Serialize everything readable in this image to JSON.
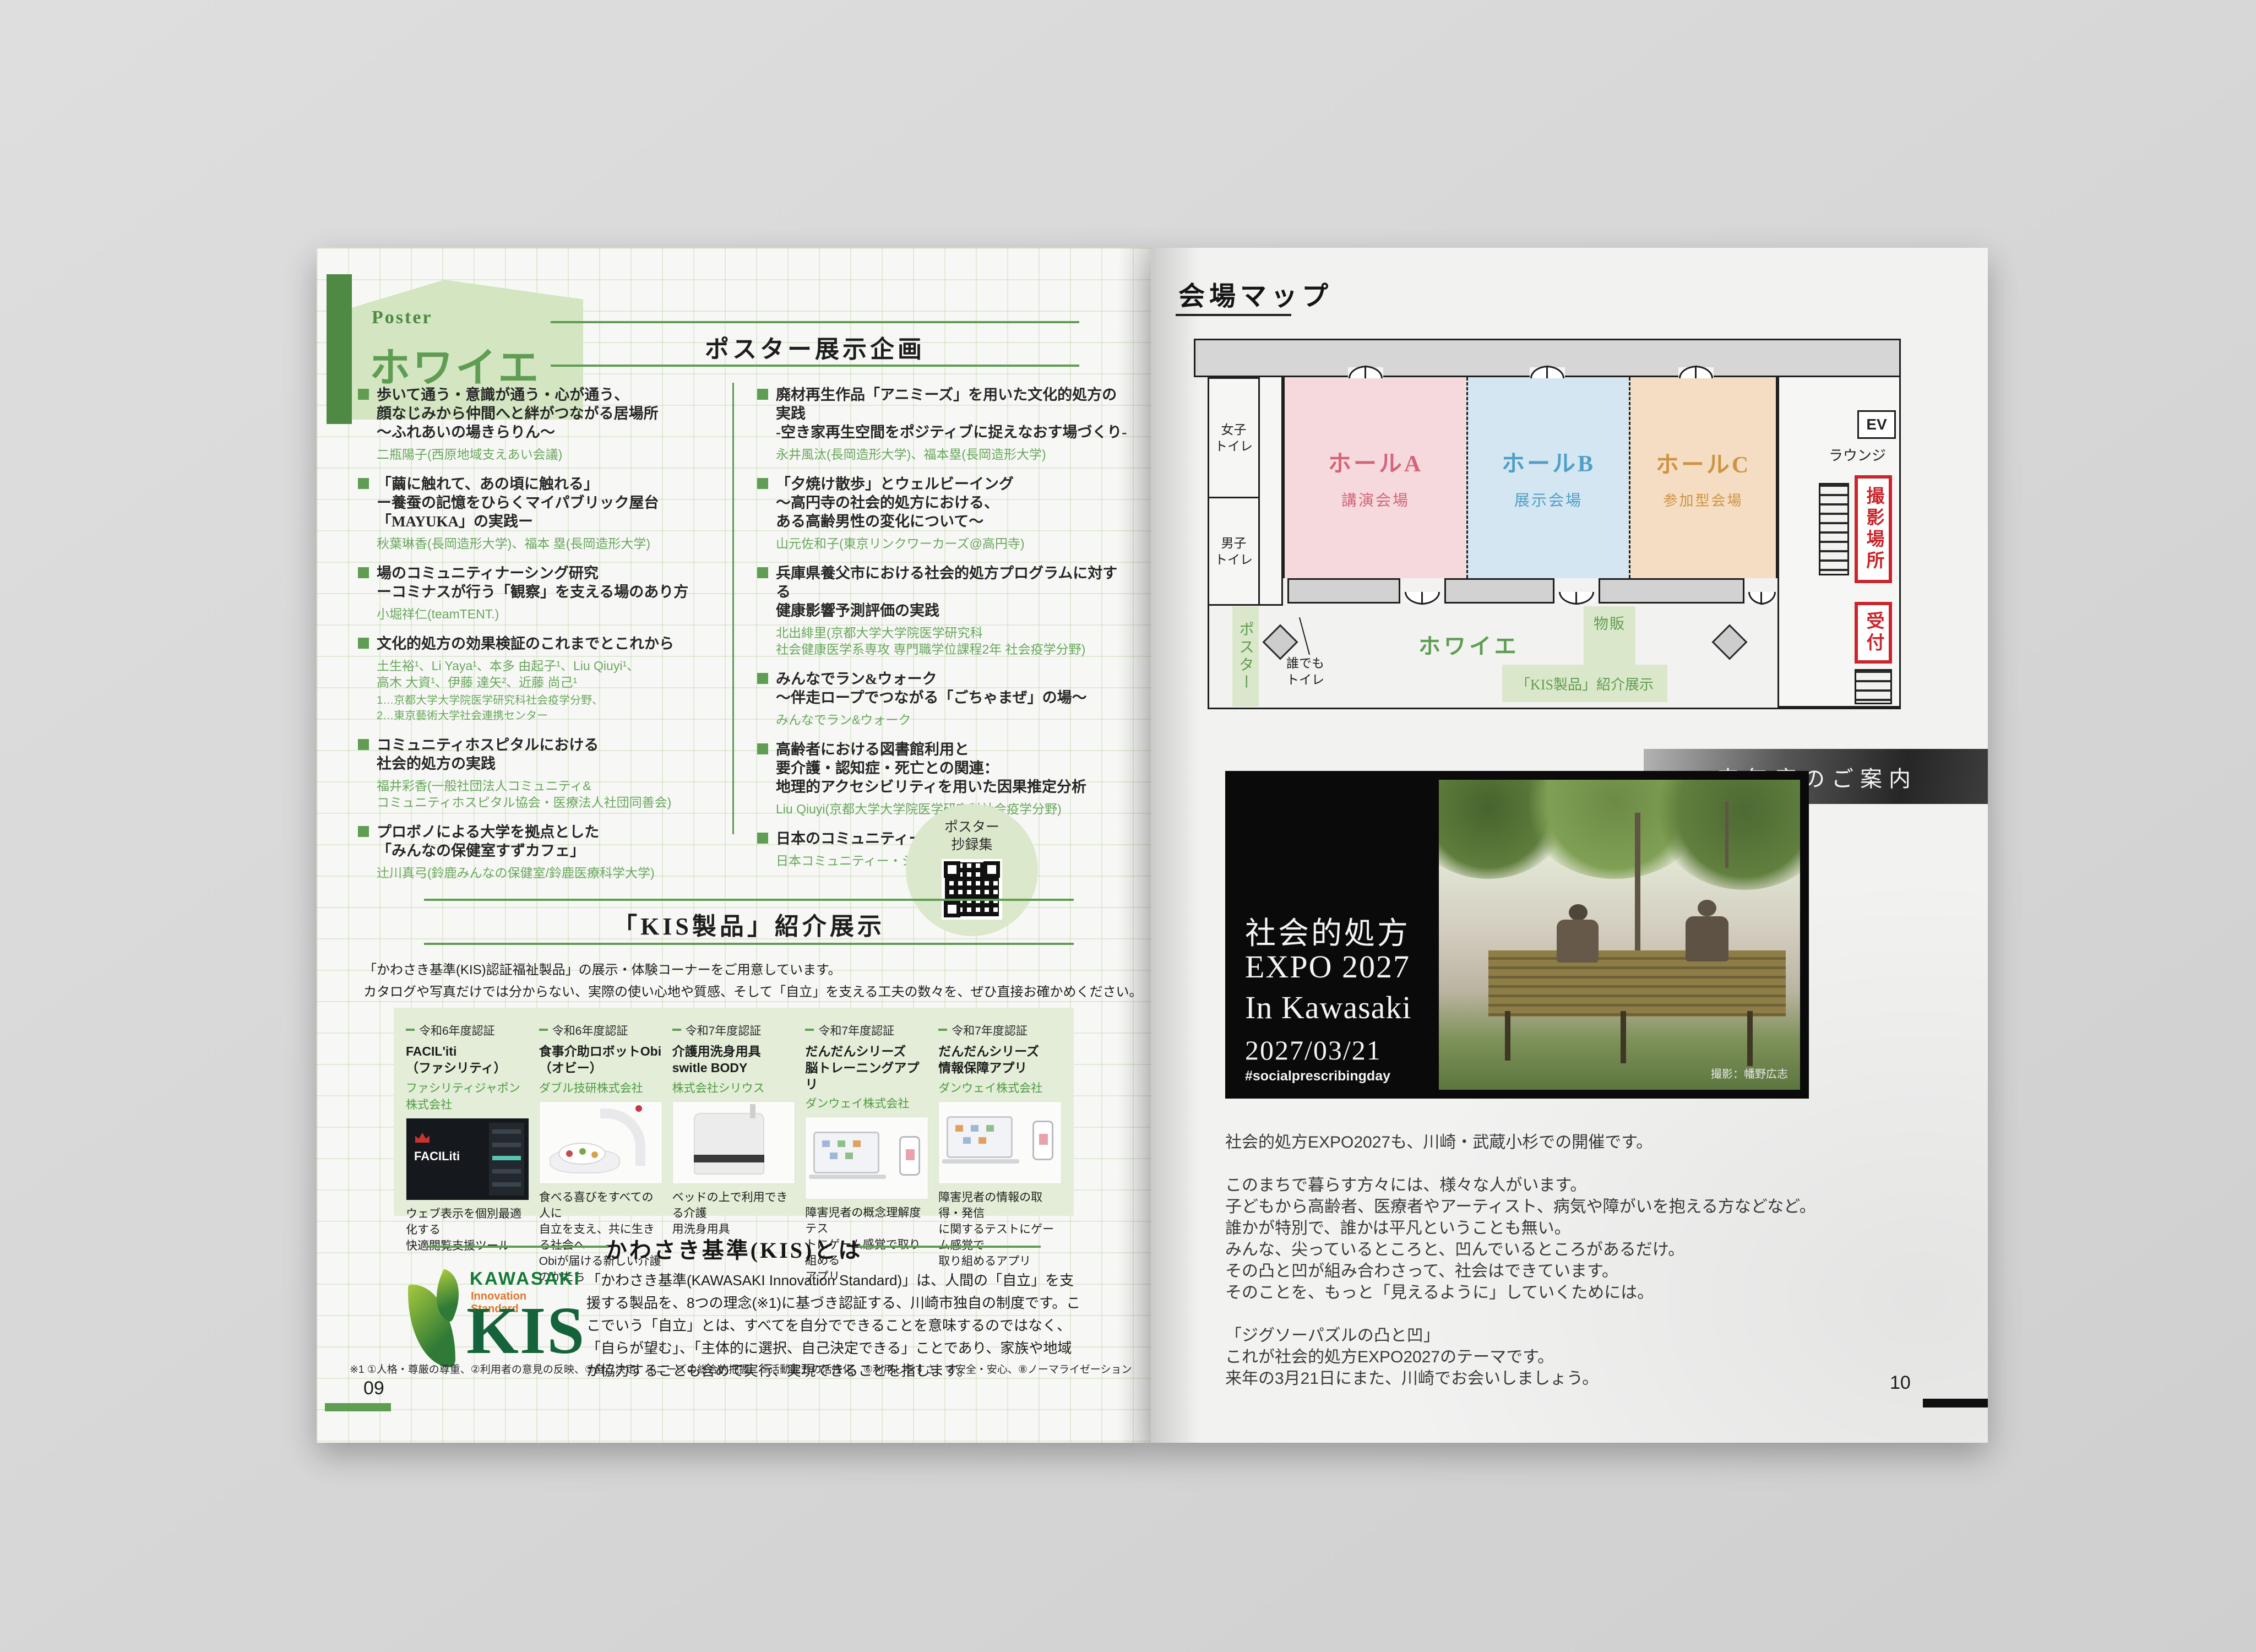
{
  "colors": {
    "accent_green": "#5f9d53",
    "deep_green": "#4e8a44",
    "hall_a_text": "#d4647a",
    "hall_b_text": "#4f9fc7",
    "hall_c_text": "#cf9344",
    "alert_red": "#c9252b"
  },
  "left_page": {
    "page_number": "09",
    "header": {
      "eyebrow": "Poster",
      "title": "ホワイエ"
    },
    "poster_section": {
      "title": "ポスター展示企画",
      "columns": {
        "left": [
          {
            "title": "歩いて通う・意識が通う・心が通う、\n顔なじみから仲間へと絆がつながる居場所\n～ふれあいの場きらりん～",
            "authors": "二瓶陽子(西原地域支えあい会議)"
          },
          {
            "title": "「繭に触れて、あの頃に触れる」\nー養蚕の記憶をひらくマイパブリック屋台\n「MAYUKA」の実践ー",
            "authors": "秋葉琳香(長岡造形大学)、福本 塁(長岡造形大学)"
          },
          {
            "title": "場のコミュニティナーシング研究\nーコミナスが行う「観察」を支える場のあり方",
            "authors": "小堀祥仁(teamTENT.)"
          },
          {
            "title": "文化的処方の効果検証のこれまでとこれから",
            "authors": "土生裕¹、Li Yaya¹、本多 由起子¹、Liu Qiuyi¹、\n高木 大資¹、伊藤 達矢²、近藤 尚己¹",
            "note": "1…京都大学大学院医学研究科社会疫学分野、\n2…東京藝術大学社会連携センター"
          },
          {
            "title": "コミュニティホスピタルにおける\n社会的処方の実践",
            "authors": "福井彩香(一般社団法人コミュニティ&\nコミュニティホスピタル協会・医療法人社団同善会)"
          },
          {
            "title": "プロボノによる大学を拠点とした\n「みんなの保健室すずカフェ」",
            "authors": "辻川真弓(鈴鹿みんなの保健室/鈴鹿医療科学大学)"
          }
        ],
        "right": [
          {
            "title": "廃材再生作品「アニミーズ」を用いた文化的処方の実践\n-空き家再生空間をポジティブに捉えなおす場づくり-",
            "authors": "永井風汰(長岡造形大学)、福本塁(長岡造形大学)"
          },
          {
            "title": "「夕焼け散歩」とウェルビーイング\n～高円寺の社会的処方における、\nある高齢男性の変化について～",
            "authors": "山元佐和子(東京リンクワーカーズ@高円寺)"
          },
          {
            "title": "兵庫県養父市における社会的処方プログラムに対する\n健康影響予測評価の実践",
            "authors": "北出緋里(京都大学大学院医学研究科\n社会健康医学系専攻 専門職学位課程2年 社会疫学分野)"
          },
          {
            "title": "みんなでラン&ウォーク\n～伴走ロープでつながる「ごちゃまぜ」の場～",
            "authors": "みんなでラン&ウォーク"
          },
          {
            "title": "高齢者における図書館利用と\n要介護・認知症・死亡との関連：\n地理的アクセシビリティを用いた因果推定分析",
            "authors": "Liu Qiuyi(京都大学大学院医学研究科社会疫学分野)"
          },
          {
            "title": "日本のコミュニティー・シェッド",
            "authors": "日本コミュニティー・シェッド協会"
          }
        ]
      },
      "qr_label": "ポスター\n抄録集"
    },
    "kis_section": {
      "title": "「KIS製品」紹介展示",
      "intro": "「かわさき基準(KIS)認証福祉製品」の展示・体験コーナーをご用意しています。\nカタログや写真だけでは分からない、実際の使い心地や質感、そして「自立」を支える工夫の数々を、ぜひ直接お確かめください。",
      "products": [
        {
          "cert": "令和6年度認証",
          "name": "FACIL'iti\n（ファシリティ）",
          "company": "ファシリティジャポン株式会社",
          "image_label": "FACILiti",
          "caption": "ウェブ表示を個別最適化する\n快適閲覧支援ツール"
        },
        {
          "cert": "令和6年度認証",
          "name": "食事介助ロボットObi\n（オビー）",
          "company": "ダブル技研株式会社",
          "caption": "食べる喜びをすべての人に\n自立を支え、共に生きる社会へ\nObiが届ける新しい介護のかたち"
        },
        {
          "cert": "令和7年度認証",
          "name": "介護用洗身用具\nswitle BODY",
          "company": "株式会社シリウス",
          "caption": "ベッドの上で利用できる介護\n用洗身用具"
        },
        {
          "cert": "令和7年度認証",
          "name": "だんだんシリーズ\n脳トレーニングアプリ",
          "company": "ダンウェイ株式会社",
          "caption": "障害児者の概念理解度テス\nトにゲーム感覚で取り組める\nアプリ"
        },
        {
          "cert": "令和7年度認証",
          "name": "だんだんシリーズ\n情報保障アプリ",
          "company": "ダンウェイ株式会社",
          "caption": "障害児者の情報の取得・発信\nに関するテストにゲーム感覚で\n取り組めるアプリ"
        }
      ]
    },
    "kis_about": {
      "title": "かわさき基準(KIS)とは",
      "logo_top": "KAWASAKI",
      "logo_sub": "Innovation Standard",
      "logo_big": "KIS",
      "body": "「かわさき基準(KAWASAKI Innovation Standard)」は、人間の「自立」を支援する製品を、8つの理念(※1)に基づき認証する、川崎市独自の制度です。ここでいう「自立」とは、すべてを自分でできることを意味するのではなく、「自らが望む」、「主体的に選択、自己決定できる」ことであり、家族や地域が協力することも含めて実行、実現できることを指します。",
      "footnote": "※1 ①人格・尊厳の尊重、②利用者の意見の反映、③自己決定、④ニーズの総合的把握、⑤活動能力の活性化、⑥利用しやすさ、⑦安全・安心、⑧ノーマライゼーション"
    }
  },
  "right_page": {
    "page_number": "10",
    "map_section": {
      "title": "会場マップ",
      "labels": {
        "womens_toilet": "女子\nトイレ",
        "mens_toilet": "男子\nトイレ",
        "hall_a": "ホールA",
        "hall_a_sub": "講演会場",
        "hall_b": "ホールB",
        "hall_b_sub": "展示会場",
        "hall_c": "ホールC",
        "hall_c_sub": "参加型会場",
        "ev": "EV",
        "lounge": "ラウンジ",
        "photo_spot": "撮影場所",
        "reception": "受付",
        "poster_area": "ポスター",
        "accessible_toilet": "誰でも\nトイレ",
        "foyer": "ホワイエ",
        "shop": "物販",
        "kis_exhibit": "「KIS製品」紹介展示"
      }
    },
    "next_year": {
      "band_title": "来年度のご案内",
      "banner": {
        "line1": "社会的処方",
        "line2": "EXPO 2027",
        "line3": "In Kawasaki",
        "date": "2027/03/21",
        "hashtag": "#socialprescribingday",
        "credit": "撮影：幡野広志"
      },
      "body": "社会的処方EXPO2027も、川崎・武蔵小杉での開催です。\n\nこのまちで暮らす方々には、様々な人がいます。\n子どもから高齢者、医療者やアーティスト、病気や障がいを抱える方などなど。\n誰かが特別で、誰かは平凡ということも無い。\nみんな、尖っているところと、凹んでいるところがあるだけ。\nその凸と凹が組み合わさって、社会はできています。\nそのことを、もっと「見えるように」していくためには。\n\n「ジグソーパズルの凸と凹」\nこれが社会的処方EXPO2027のテーマです。\n来年の3月21日にまた、川崎でお会いしましょう。"
    }
  }
}
